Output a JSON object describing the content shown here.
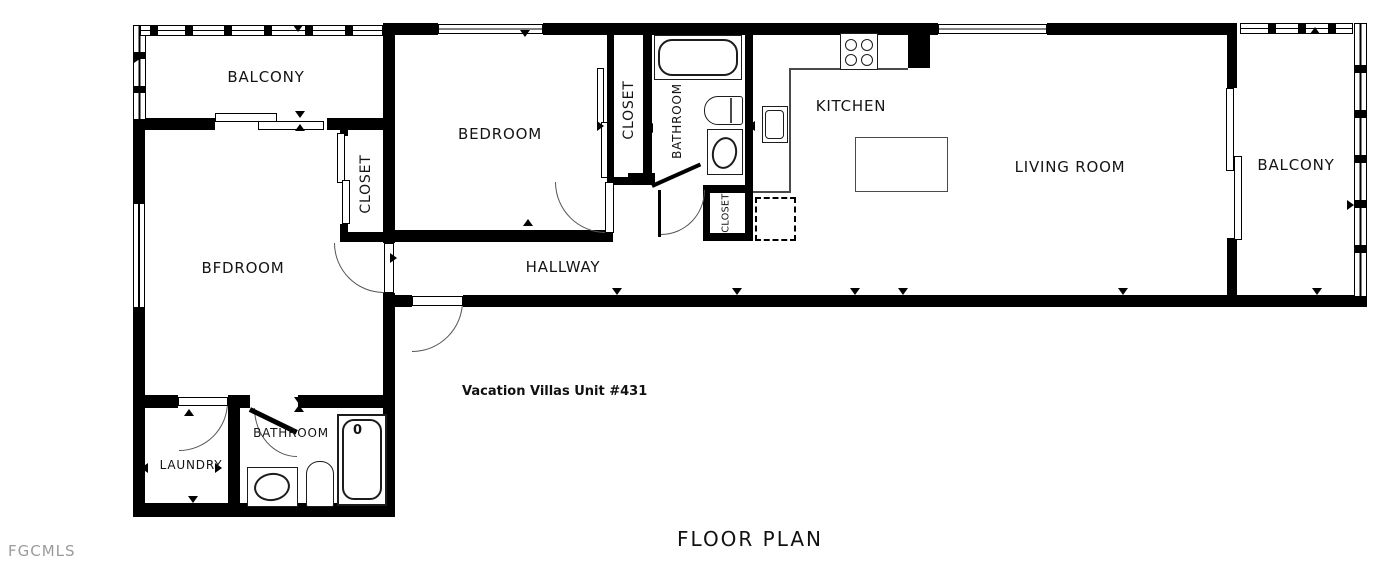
{
  "meta": {
    "title": "FLOOR PLAN",
    "unit": "Vacation Villas Unit #431",
    "watermark": "FGCMLS"
  },
  "rooms": {
    "balcony_left": "BALCONY",
    "bedroom_top": "BEDROOM",
    "closet_left": "CLOSET",
    "closet_mid": "CLOSET",
    "bathroom_top": "BATHROOM",
    "closet_small": "CLOSET",
    "kitchen": "KITCHEN",
    "living_room": "LIVING ROOM",
    "balcony_right": "BALCONY",
    "bedroom_left": "BFDROOM",
    "hallway": "HALLWAY",
    "laundry": "LAUNDRY",
    "bathroom_bottom": "BATHROOM"
  },
  "fixtures": {
    "tub_mark": "0"
  },
  "colors": {
    "wall": "#000000",
    "background": "#ffffff",
    "watermark": "#9b9b9b"
  }
}
